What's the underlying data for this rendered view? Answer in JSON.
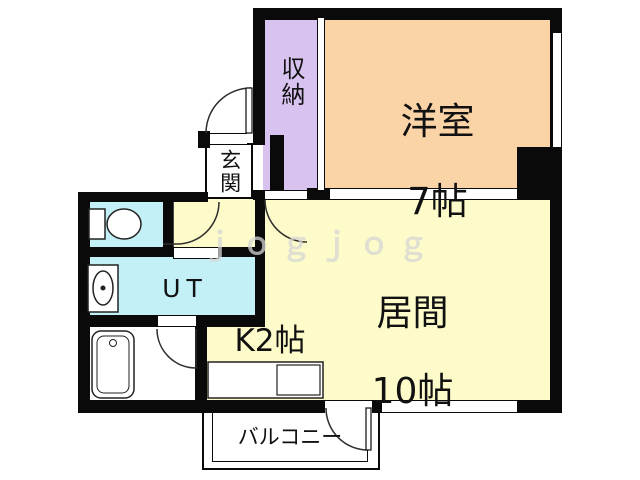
{
  "title": "apartment-floor-plan",
  "rooms": {
    "western_room": {
      "name": "洋室",
      "size": "7帖"
    },
    "living_room": {
      "name": "居間",
      "size": "10帖"
    },
    "kitchen": {
      "label": "K2帖"
    },
    "closet": {
      "label": "収納"
    },
    "entrance": {
      "label": "玄関"
    },
    "utility": {
      "label": "UT"
    },
    "balcony": {
      "label": "バルコニー"
    }
  },
  "fixtures": [
    "toilet",
    "washing-machine",
    "bathtub",
    "kitchen-counter-sink"
  ],
  "watermark": "ｊｏｇｊｏｇ",
  "colors": {
    "wall": "#0a0a0a",
    "western_room": "#fad3a6",
    "living_room": "#fdfbc9",
    "closet": "#d8c2ef",
    "water": "#c3eff7",
    "line": "#2e2e2e",
    "watermark": "#d6d6d6"
  }
}
